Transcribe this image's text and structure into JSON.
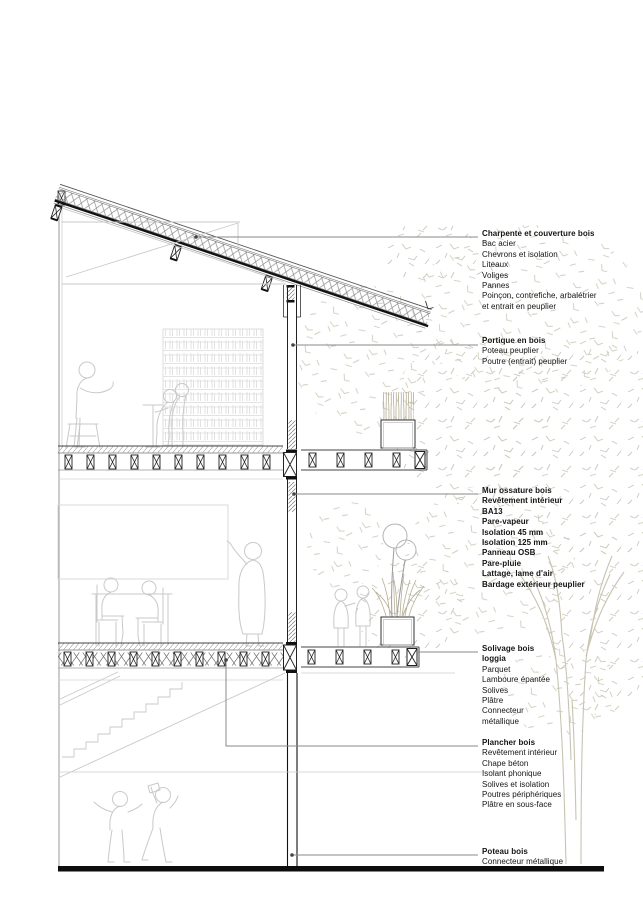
{
  "page": {
    "title": "Coupe constructive — détail bois",
    "background": "#ffffff"
  },
  "colors": {
    "ink": "#1a1a1a",
    "leader": "#8a8a8a",
    "silhouette": "#c9c9c9",
    "furniture": "#d9d9d9",
    "foliage": "#cdc9b9",
    "plant": "#b3ae95",
    "trunk": "#c8c4b2"
  },
  "annotations": [
    {
      "id": "charpente",
      "lines": [
        {
          "text": "Charpente et couverture bois",
          "bold": true
        },
        {
          "text": "Bac acier",
          "bold": false
        },
        {
          "text": "Chevrons et isolation",
          "bold": false
        },
        {
          "text": "Liteaux",
          "bold": false
        },
        {
          "text": "Voliges",
          "bold": false
        },
        {
          "text": "Pannes",
          "bold": false
        },
        {
          "text": "Poinçon, contrefiche, arbalétrier",
          "bold": false
        },
        {
          "text": "et entrait en peuplier",
          "bold": false
        }
      ]
    },
    {
      "id": "portique",
      "lines": [
        {
          "text": "Portique en bois",
          "bold": true
        },
        {
          "text": "Poteau peuplier",
          "bold": false
        },
        {
          "text": "Poutre (entrait) peuplier",
          "bold": false
        }
      ]
    },
    {
      "id": "mur-ossature",
      "lines": [
        {
          "text": "Mur ossature bois",
          "bold": true
        },
        {
          "text": "Revêtement intérieur",
          "bold": true
        },
        {
          "text": "BA13",
          "bold": true
        },
        {
          "text": "Pare-vapeur",
          "bold": true
        },
        {
          "text": "Isolation 45 mm",
          "bold": true
        },
        {
          "text": "Isolation 125 mm",
          "bold": true
        },
        {
          "text": "Panneau OSB",
          "bold": true
        },
        {
          "text": "Pare-pluie",
          "bold": true
        },
        {
          "text": "Lattage, lame d'air",
          "bold": true
        },
        {
          "text": "Bardage extérieur peuplier",
          "bold": true
        }
      ]
    },
    {
      "id": "solivage",
      "lines": [
        {
          "text": "Solivage bois",
          "bold": true
        },
        {
          "text": "loggia",
          "bold": true
        },
        {
          "text": "Parquet",
          "bold": false
        },
        {
          "text": "Lamboure épantée",
          "bold": false
        },
        {
          "text": "Solives",
          "bold": false
        },
        {
          "text": "Plâtre",
          "bold": false
        },
        {
          "text": "Connecteur",
          "bold": false
        },
        {
          "text": "métallique",
          "bold": false
        }
      ]
    },
    {
      "id": "plancher",
      "lines": [
        {
          "text": "Plancher bois",
          "bold": true
        },
        {
          "text": "Revêtement intérieur",
          "bold": false
        },
        {
          "text": "Chape béton",
          "bold": false
        },
        {
          "text": "Isolant phonique",
          "bold": false
        },
        {
          "text": "Solives et isolation",
          "bold": false
        },
        {
          "text": "Poutres périphériques",
          "bold": false
        },
        {
          "text": "Plâtre en sous-face",
          "bold": false
        }
      ]
    },
    {
      "id": "poteau",
      "lines": [
        {
          "text": "Poteau bois",
          "bold": true
        },
        {
          "text": "Connecteur métallique",
          "bold": false
        }
      ]
    }
  ]
}
